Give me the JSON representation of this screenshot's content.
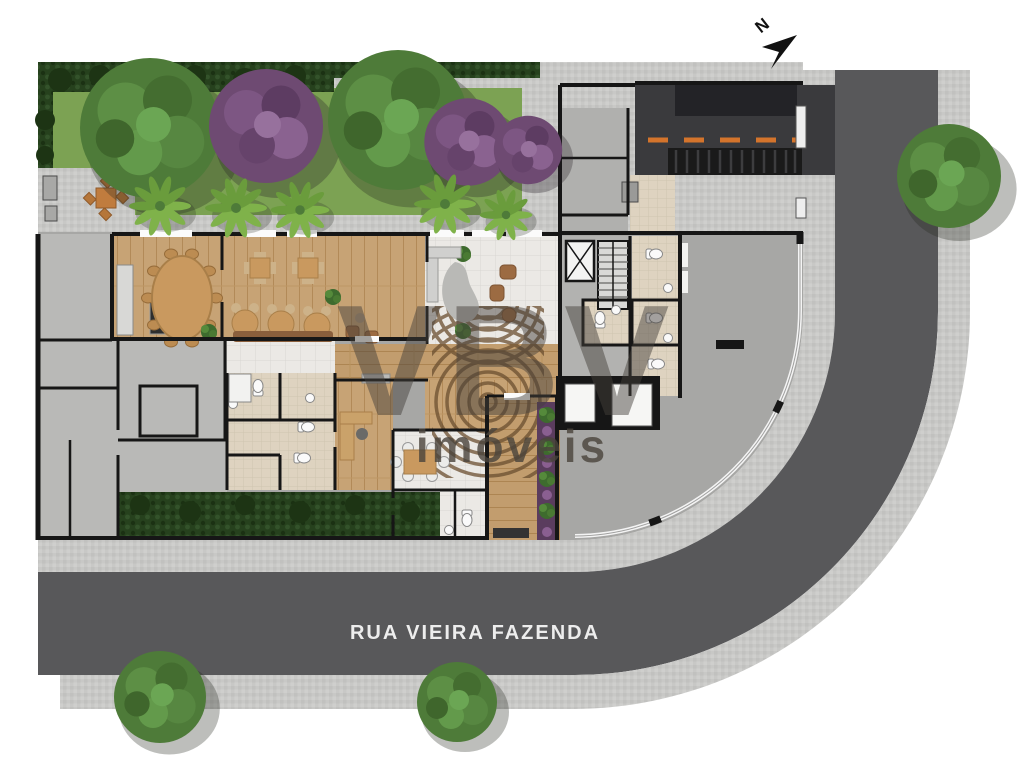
{
  "title": "Ground floor site plan",
  "street": {
    "name": "RUA VIEIRA FAZENDA"
  },
  "compass": {
    "label": "N"
  },
  "watermark": {
    "logo": "VBV",
    "subtitle": "imóveis"
  },
  "colors": {
    "road": "#58585a",
    "driveway_asphalt": "#3a3a3d",
    "driveway_dash": "#d4742c",
    "sidewalk": "#c8c8c6",
    "plaza": "#a7a7a5",
    "lawn": "#7ca253",
    "hedge": "#26411d",
    "wood_floor": "#c7a375",
    "tile_floor": "#ebe9e5",
    "bath_floor": "#ded3c0",
    "service_floor": "#b9b9b7",
    "wall": "#161616",
    "furniture_wood": "#c9995f"
  },
  "trees": [
    {
      "zone": "street-bottom",
      "type": "green",
      "x": 160,
      "y": 697,
      "s": 1.15
    },
    {
      "zone": "street-bottom",
      "type": "green",
      "x": 457,
      "y": 702,
      "s": 1.0
    },
    {
      "zone": "street-right",
      "type": "green",
      "x": 949,
      "y": 176,
      "s": 1.3
    },
    {
      "zone": "garden",
      "type": "green",
      "x": 150,
      "y": 128,
      "s": 1.75
    },
    {
      "zone": "garden",
      "type": "purple",
      "x": 266,
      "y": 126,
      "s": 1.5
    },
    {
      "zone": "garden",
      "type": "green",
      "x": 398,
      "y": 120,
      "s": 1.75
    },
    {
      "zone": "garden",
      "type": "purple",
      "x": 468,
      "y": 142,
      "s": 1.15
    },
    {
      "zone": "entry",
      "type": "purple",
      "x": 528,
      "y": 150,
      "s": 0.9
    },
    {
      "zone": "garden-walk",
      "type": "palm",
      "x": 160,
      "y": 206,
      "s": 1.0
    },
    {
      "zone": "garden-walk",
      "type": "palm",
      "x": 236,
      "y": 208,
      "s": 1.0
    },
    {
      "zone": "garden-walk",
      "type": "palm",
      "x": 300,
      "y": 210,
      "s": 0.95
    },
    {
      "zone": "garden-walk",
      "type": "palm",
      "x": 445,
      "y": 204,
      "s": 1.0
    },
    {
      "zone": "garden-walk",
      "type": "palm",
      "x": 506,
      "y": 215,
      "s": 0.85
    }
  ]
}
